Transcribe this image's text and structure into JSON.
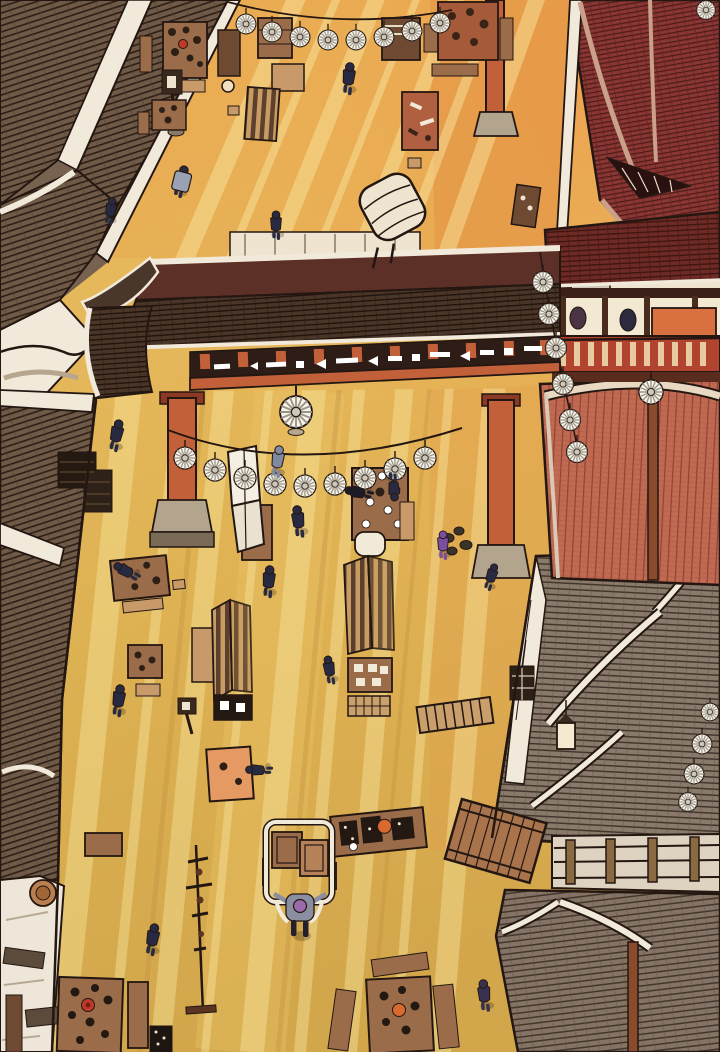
{
  "meta": {
    "title": "Overhead festival market street",
    "art_style": "color manhwa illustration, bird's-eye view",
    "canvas": {
      "width": 720,
      "height": 1052
    }
  },
  "scene": {
    "description": "Bird's-eye view of a sunlit traditional market street: dark tiled rooftops on the left, a large gate with a decorated frieze spanning the street, a red veranda building and sunset-lit tiled roofs on the right, strings of white paper-fan garlands, many food stalls and tables, and small pedestrians in dark clothing; one figure pulls a hand cart at bottom center.",
    "time_of_day": "late afternoon, long diagonal sun rays on golden dirt street",
    "regions": [
      "rooftops-top-left",
      "street-upper",
      "gate",
      "veranda-building",
      "temple-roof-top-right",
      "sunset-roof-right",
      "rooftops-right",
      "rooftops-left",
      "courtyard-bottom-left",
      "street-lower"
    ],
    "pedestrians": {
      "count": 19,
      "attire_colors": [
        "navy",
        "grey-blue",
        "purple"
      ]
    },
    "garlands": {
      "style": "string of striped paper fans",
      "strings": 4,
      "fan_count": 30
    },
    "stalls": {
      "count": 22,
      "types": [
        "food table with dishes",
        "striped-roof stall",
        "folding-screen stall",
        "covered wagon",
        "hand cart",
        "flat wooden cart",
        "bench",
        "lamp post",
        "pole rack",
        "storage crates",
        "barrel"
      ]
    }
  },
  "palette": {
    "ink": "#241712",
    "street-gold": "#dfb558",
    "street-gold-light": "#f0d47c",
    "street-gold-deep": "#c3913f",
    "street-orange": "#e8a352",
    "ray": "#f8e49c",
    "roof-brown": "#6f5947",
    "roof-dark": "#4a3629",
    "eave-white": "#f1e9da",
    "maroon": "#8a3633",
    "pink-roof": "#c16a52",
    "grey-roof": "#8a7a6b",
    "gate-orange": "#c2603a",
    "frieze-dark": "#2d1d16",
    "wood-brown": "#9a6c49",
    "wood-dark": "#6e4a32",
    "table-tan": "#c89a6a",
    "canopy-cream": "#efe4cf",
    "stone-grey": "#b3a48e",
    "salmon": "#e59a63",
    "navy": "#272a40",
    "grey-blue": "#8089a0",
    "purple": "#7b4fa0",
    "red-dish": "#c03a2a",
    "orange-dish": "#d96a2f"
  }
}
